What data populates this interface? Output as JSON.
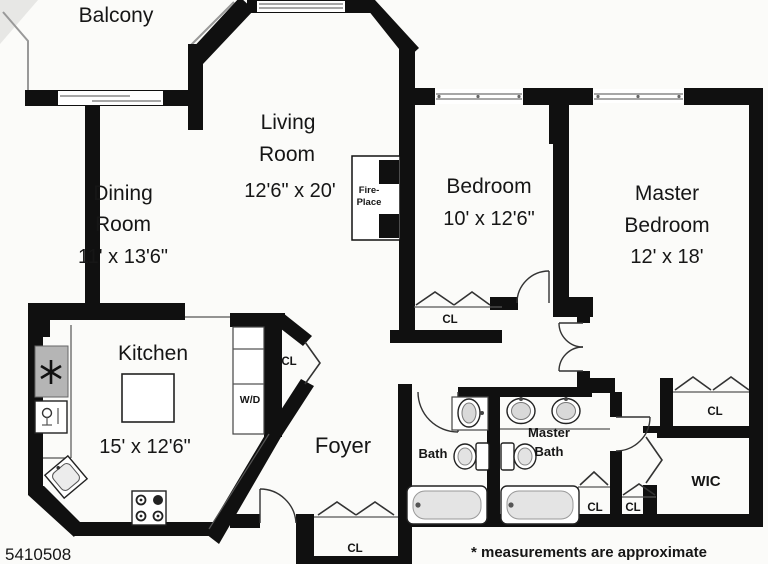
{
  "rooms": {
    "balcony": {
      "line1": "Balcony"
    },
    "dining": {
      "line1": "Dining",
      "line2": "Room",
      "dims": "11' x 13'6\""
    },
    "living": {
      "line1": "Living",
      "line2": "Room",
      "dims": "12'6\" x 20'"
    },
    "bedroom": {
      "line1": "Bedroom",
      "dims": "10' x 12'6\""
    },
    "master_bedroom": {
      "line1": "Master",
      "line2": "Bedroom",
      "dims": "12' x 18'"
    },
    "kitchen": {
      "line1": "Kitchen",
      "dims": "15' x 12'6\""
    },
    "foyer": {
      "line1": "Foyer"
    },
    "bath": {
      "line1": "Bath"
    },
    "master_bath": {
      "line1": "Master",
      "line2": "Bath"
    },
    "wic": {
      "line1": "WIC"
    }
  },
  "fixtures": {
    "fireplace": {
      "line1": "Fire-",
      "line2": "Place"
    }
  },
  "labels": {
    "closet": "CL",
    "washer_dryer": "W/D"
  },
  "footer": {
    "listing_id": "5410508",
    "disclaimer": "* measurements are approximate"
  },
  "colors": {
    "wall": "#101010",
    "paper": "#fbfbf9",
    "appliance_gray": "#b5b5b5",
    "tub_gray": "#e4e4e4"
  }
}
